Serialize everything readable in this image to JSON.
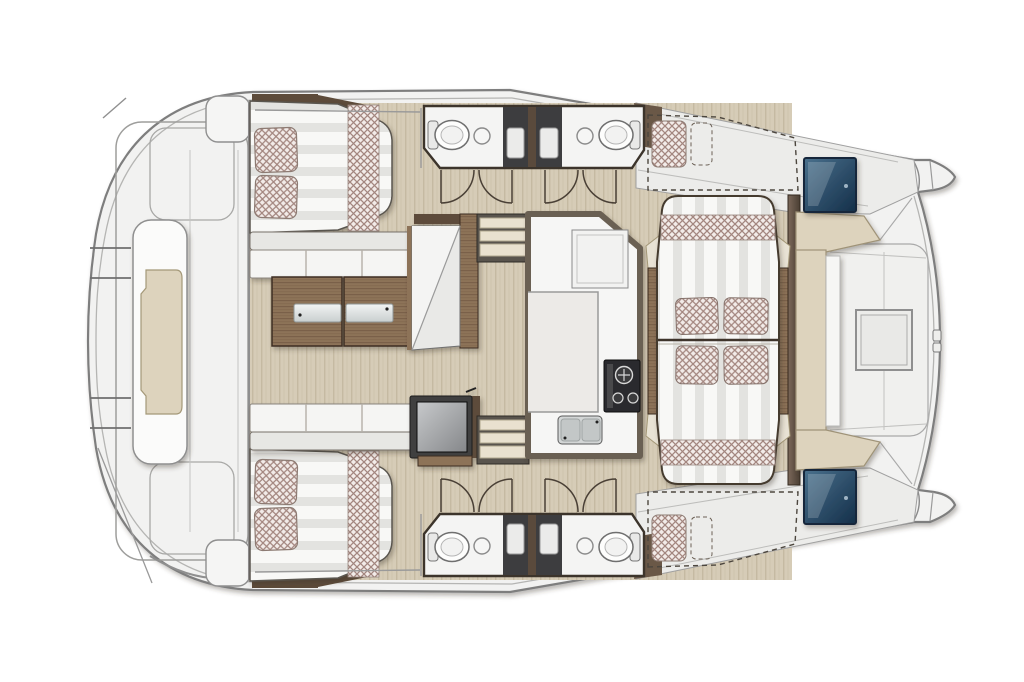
{
  "plan": {
    "vessel_type": "catamaran",
    "view": "top-down deck and accommodation plan, bow pointing right",
    "regions": [
      {
        "id": "hull-outline",
        "label": "Catamaran hull and deck outline"
      },
      {
        "id": "aft-deck",
        "label": "Aft deck platform with central lounge seat"
      },
      {
        "id": "aft-lounge",
        "label": "Aft deck lounge seat with beige cushion"
      },
      {
        "id": "cabin-port-aft",
        "label": "Port aft cabin with double berth and two pillows"
      },
      {
        "id": "cabin-stbd-aft",
        "label": "Starboard aft cabin with double berth and two pillows"
      },
      {
        "id": "salon",
        "label": "Salon with facing sofas and folding coffee table"
      },
      {
        "id": "coffee-table",
        "label": "Wood coffee table with two folding tray leaves"
      },
      {
        "id": "nav-seat",
        "label": "Forward facing chaise / chart seat"
      },
      {
        "id": "tv-unit",
        "label": "TV cabinet on swivel mount"
      },
      {
        "id": "steps-port",
        "label": "Port companionway steps into hull"
      },
      {
        "id": "steps-stbd",
        "label": "Starboard companionway steps into hull"
      },
      {
        "id": "heads-port",
        "label": "Port hull bathrooms: two toilets, two sinks, two shower stalls"
      },
      {
        "id": "heads-stbd",
        "label": "Starboard hull bathrooms: two toilets, two sinks, two shower stalls"
      },
      {
        "id": "galley",
        "label": "L-shaped galley with stove, double sink and refrigerator"
      },
      {
        "id": "dinette",
        "label": "Forward dinette with facing benches, four cushions and side tables"
      },
      {
        "id": "berth-port-fwd",
        "label": "Optional forepeak berth port (dashed)"
      },
      {
        "id": "berth-stbd-fwd",
        "label": "Optional forepeak berth starboard (dashed)"
      },
      {
        "id": "foredeck",
        "label": "Solid foredeck with C-shaped bench and central hatch"
      },
      {
        "id": "hatch-port",
        "label": "Port forward deck hatch (tinted glass)"
      },
      {
        "id": "hatch-stbd",
        "label": "Starboard forward deck hatch (tinted glass)"
      },
      {
        "id": "bow-port",
        "label": "Port bow"
      },
      {
        "id": "bow-stbd",
        "label": "Starboard bow"
      }
    ]
  },
  "palette": {
    "background": "#ffffff",
    "deck": "#f2f2f1",
    "deck_shade": "#ececea",
    "deck_line": "#7e7e7e",
    "deck_line_soft": "#b5b5b3",
    "wood_floor": "#d6ccb7",
    "wood_floor_grain": "#c5baa2",
    "furniture_wood": "#8d7358",
    "furniture_wood_grain": "#7a6149",
    "furniture_wood_dark": "#5d4b3a",
    "wall_brown": "#6b6052",
    "wall_dark": "#3c342b",
    "mattress": "#f8f8f6",
    "mattress_stripe": "#e3e3e0",
    "checker_base": "#f2ebe8",
    "checker_line": "#a3867f",
    "shower_dark": "#3d3d3f",
    "fixture_white": "#f4f4f3",
    "hatch_blue_light": "#4a718d",
    "hatch_blue_dark": "#142f49",
    "bench_beige": "#ddd3bd",
    "bench_beige_line": "#a49878",
    "steel_light": "#f2f4f4",
    "steel_dark": "#c9cfcf",
    "stove_dark": "#2b2b2d",
    "screen_light": "#c7c9cb",
    "screen_dark": "#85878a"
  }
}
